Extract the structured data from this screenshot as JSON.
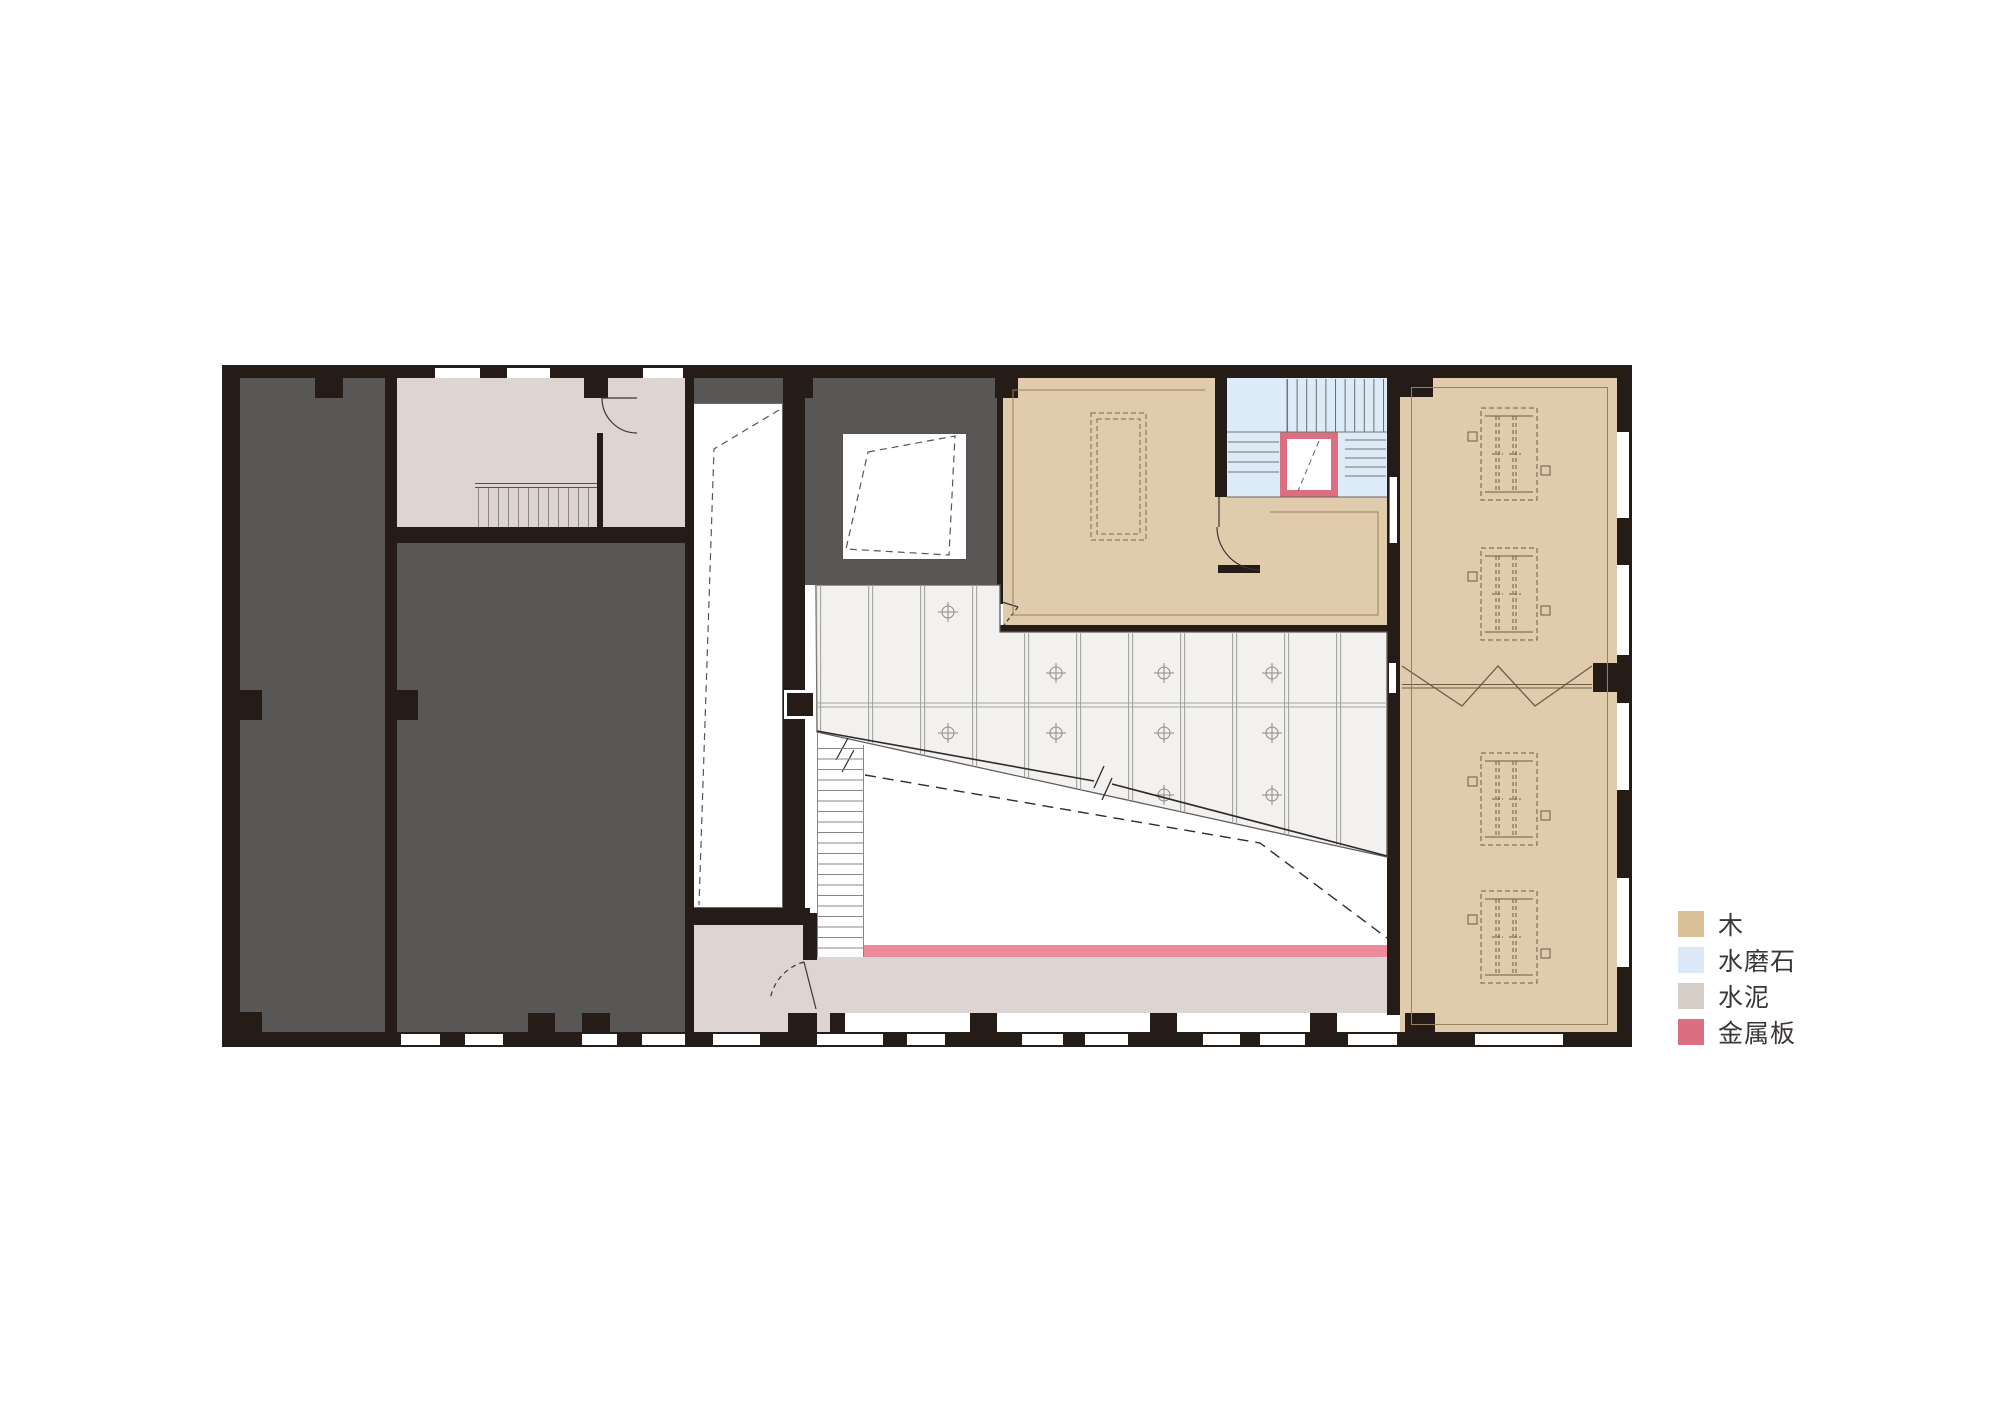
{
  "legend": {
    "items": [
      {
        "id": "wood",
        "label": "木",
        "color": "#d9c096"
      },
      {
        "id": "terrazzo",
        "label": "水磨石",
        "color": "#dbe9f6"
      },
      {
        "id": "cement",
        "label": "水泥",
        "color": "#d6cdc6"
      },
      {
        "id": "metal",
        "label": "金属板",
        "color": "#dc6e82"
      }
    ]
  },
  "palette": {
    "wall": "#251b17",
    "room_dark": "#595656",
    "wood": "#e1cbad",
    "terrazzo": "#dcebf7",
    "cement": "#ded5d2",
    "glazing": "#f2f1ef",
    "metal": "#dc6e82",
    "metal_strip": "#ec8a9c",
    "white": "#ffffff"
  }
}
